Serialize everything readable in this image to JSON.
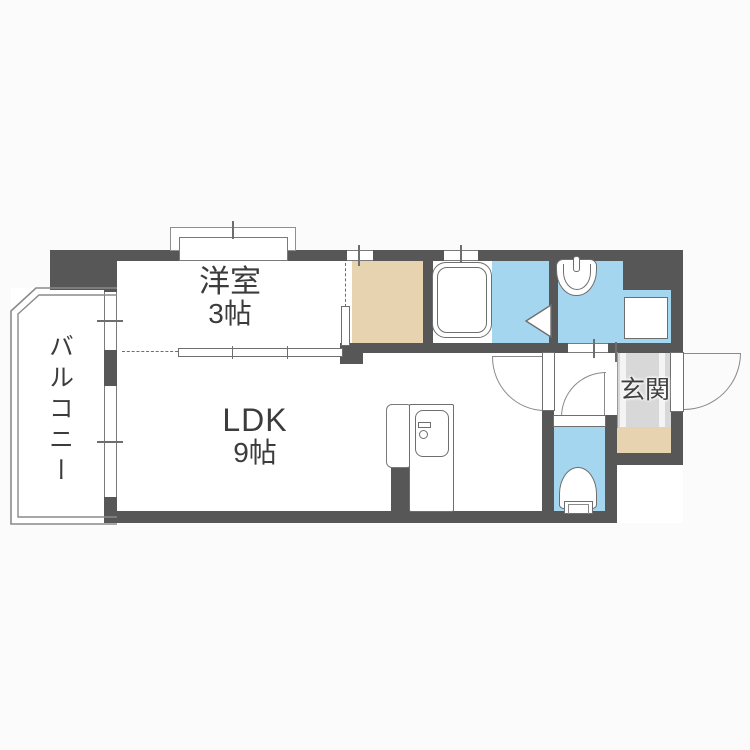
{
  "title": "apartment-floor-plan",
  "rooms": {
    "western_room": {
      "name": "洋室",
      "size": "3帖"
    },
    "ldk": {
      "name": "LDK",
      "size": "9帖"
    },
    "balcony": {
      "label": "バルコニー"
    },
    "entrance": {
      "label": "玄関"
    },
    "unlabeled": [
      "closet",
      "bathroom",
      "washroom",
      "toilet",
      "hallway"
    ]
  },
  "fixtures": {
    "icons": [
      "bathtub-icon",
      "wash-basin-icon",
      "washing-machine-pan-icon",
      "toilet-icon",
      "kitchen-unit-icon",
      "door-swing-arc",
      "folding-door-triangle",
      "sliding-door",
      "bay-window"
    ]
  },
  "colors": {
    "wall": "#575757",
    "wet_area_floor": "#a5d6f0",
    "closet_floor": "#e8d3b1",
    "entrance_floor": "#d8d8d8",
    "entrance_step": "#e8d3b1",
    "room_floor": "#ffffff",
    "line": "#6e6e6e",
    "text": "#3c3c3c"
  }
}
